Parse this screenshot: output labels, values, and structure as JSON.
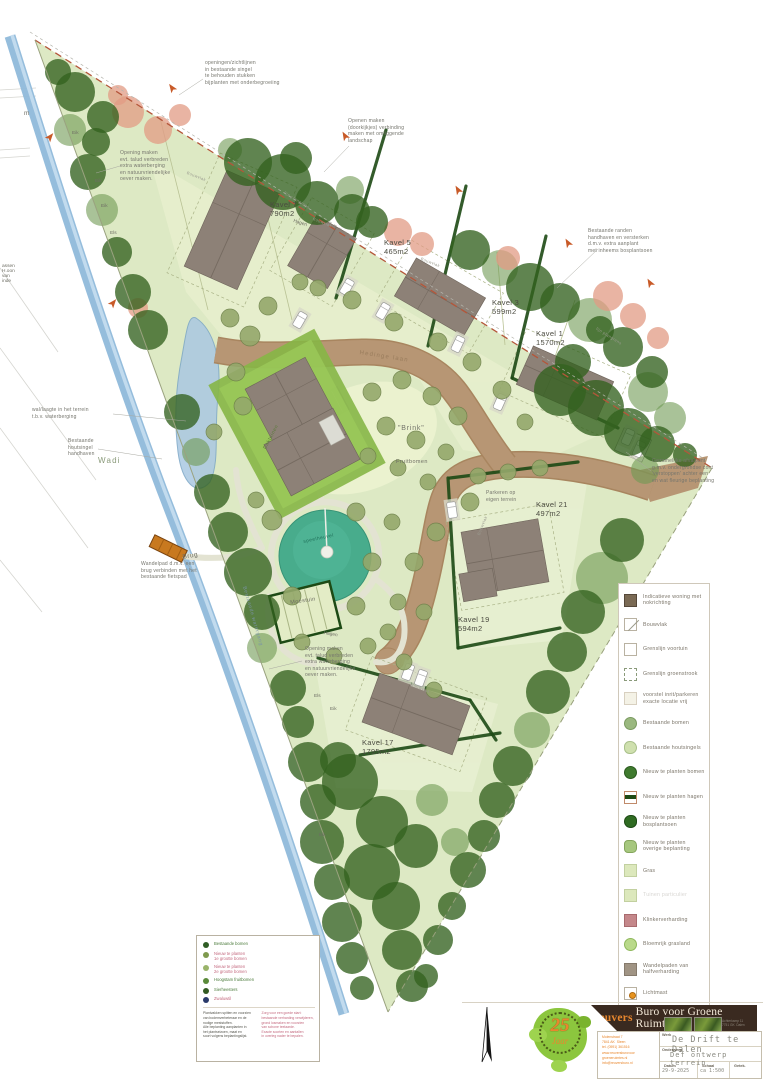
{
  "map": {
    "plots": [
      {
        "name": "Kavel 7",
        "area": "790m2"
      },
      {
        "name": "Kavel 5",
        "area": "465m2"
      },
      {
        "name": "Kavel 3",
        "area": "599m2"
      },
      {
        "name": "Kavel 1",
        "area": "1570m2"
      },
      {
        "name": "Kavel 21",
        "area": "497m2"
      },
      {
        "name": "Kavel 19",
        "area": "594m2"
      },
      {
        "name": "Kavel 17",
        "area": "1795m2"
      }
    ],
    "annotations": {
      "openings_top": [
        "openingen/zichtlijnen",
        "in bestaande singel",
        "te behouden stukken",
        "bijplanten met onderbegroeiing"
      ],
      "doorkijkjes": [
        "Openen maken",
        "(doorkijkjes) verbinding",
        "maken met omliggende",
        "landschap"
      ],
      "talud_left": [
        "Opening maken",
        "evt. talud verbreden",
        "extra waterberging",
        "en natuurvriendelijke",
        "oever maken."
      ],
      "randen": [
        "Bestaande randen",
        "handhaven en versterken",
        "d.m.v. extra aanplant",
        "met inheems bosplantsoen"
      ],
      "wal": [
        "wal/laagte in het terrein",
        "t.b.v. waterberging"
      ],
      "houtsingel": [
        "Bestaande",
        "houtsingel",
        "handhaven"
      ],
      "afvalpunt": [
        "Gezamelijke afvalpunt",
        "g.m.v. ondergrondse cont",
        "'verstoppen' achter een",
        "en wat fleurige beplanting"
      ],
      "wandelpad": [
        "Wandelpad d.m.v. een",
        "brug verbinden met het",
        "bestaande fietspad"
      ],
      "talud_south": [
        "Opening maken",
        "evt. talud verbreden",
        "extra waterberging",
        "en natuurvriendelijke",
        "oever maken."
      ],
      "parkeren": [
        "Parkeren op",
        "eigen terrein"
      ]
    },
    "labels": {
      "brink": "\"Brink\"",
      "fruitbomen": "Fruitbomen",
      "wadi": "Wadi",
      "brug": "Brug",
      "moestuin": "Moestuin",
      "hagen": "Hagen",
      "speelheuvel": "speelheuvel",
      "daktuinen": "Daktuinen",
      "watergang": "Bestaande watergang",
      "bouwvlak": "Bouwvlak",
      "grens": "lijn plangrens",
      "straat": "Hedinge laan",
      "eik": "Eik",
      "els": "Els",
      "m": "m",
      "cut_text": "assen\nH.oon\nvan\ninde"
    }
  },
  "legend_right": {
    "items": [
      {
        "label": "Indicatieve woning\nmet nokrichting",
        "type": "woning"
      },
      {
        "label": "Bouwvlak",
        "type": "diag"
      },
      {
        "label": "Grenslijn voortuin",
        "type": "voortuin"
      },
      {
        "label": "Grenslijn groenstrook",
        "type": "dashdot"
      },
      {
        "label": "voorstel inrit/parkeren\nexacte locatie vrij",
        "type": "inrit"
      },
      {
        "label": "Bestaande bomen",
        "type": "circ_best"
      },
      {
        "label": "Bestaande houtsingels",
        "type": "blob_pale"
      },
      {
        "label": "Nieuw te planten bomen",
        "type": "circ_new"
      },
      {
        "label": "Nieuw te planten hagen",
        "type": "bar"
      },
      {
        "label": "Nieuw te planten\nbosplantsoen",
        "type": "blob_dark"
      },
      {
        "label": "Nieuw te planten\noverige beplanting",
        "type": "blob_mid"
      },
      {
        "label": "Gras",
        "type": "gras"
      },
      {
        "label": "Tuinen particulier",
        "type": "tuin",
        "faint": true
      },
      {
        "label": "Klinkerverharding",
        "type": "klinker"
      },
      {
        "label": "Bloemrijk grasland",
        "type": "bloem"
      },
      {
        "label": "Wandelpaden van\nhalfverharding",
        "type": "half"
      },
      {
        "label": "Lichtmast",
        "type": "mast"
      }
    ]
  },
  "legend_box": {
    "items": [
      {
        "dot": "#2f5d25",
        "cls": "lb-green",
        "lines": [
          "Bestaande bomen"
        ]
      },
      {
        "dot": "#7f9a4e",
        "cls": "lb-pink",
        "lines": [
          "Nieuw te planten",
          "1e grootte bomen"
        ]
      },
      {
        "dot": "#9ab46a",
        "cls": "lb-pink",
        "lines": [
          "Nieuw te planten",
          "2e grootte bomen"
        ]
      },
      {
        "dot": "#5a8a3a",
        "cls": "lb-green",
        "lines": [
          "Hoogstam fruitbomen"
        ]
      },
      {
        "dot": "#335a22",
        "cls": "lb-green",
        "lines": [
          "Sierheesters"
        ]
      },
      {
        "dot": "#2a3a6a",
        "cls": "lb-pink",
        "lines": [
          "Zwaluwtil"
        ]
      }
    ],
    "note_black": "Plantvakken spitten en voorzien\nvan bodemverbeteraar en de\nnodige meststoffen.\nAlle beplanting aanplanten in\nhet plantseizoen, maat en\nsoort volgens beplantingslijst.",
    "note_pink": "Zorg voor een goede start:\nbestaande verharding verwijderen,\ngrond losmaken en voorzien\nvan schone teelaarde.\nExacte soorten en aantallen\nin overleg nader te bepalen."
  },
  "title_block": {
    "firm_prefix": "Reuvers",
    "firm_rest": "Buro voor Groene Ruimtes",
    "logo": {
      "big": "25",
      "script": "Jaar"
    },
    "address_lines": [
      "Molenstraat 7",
      "7841 AK  Sleen",
      "tel. (0591) 361516"
    ],
    "web_lines": [
      "www.reuversburovoor",
      "groeneruimtes.nl",
      "info@reuversburo.nl"
    ],
    "photo_caption_lines": [
      "Achterkamp 11",
      "7751 GK  Dalen"
    ],
    "fields": {
      "werk_label": "Werk",
      "werk": "De Drift te Dalen",
      "onderwerp_label": "Onderwerp",
      "onderwerp": "Def ontwerp terrein",
      "datum_label": "Datum",
      "datum": "29-9-2025",
      "schaal_label": "Schaal",
      "schaal": "ca 1:500",
      "getek_label": "Getek."
    }
  },
  "colors": {
    "grass": "#dde9c4",
    "grass_light": "#e8f0d2",
    "tree_dark": "#33621f",
    "tree_light": "#6f9a53",
    "tree_olive": "#94a86b",
    "shrub_salmon": "#e29b84",
    "road": "#b79674",
    "road_edge": "#a8855f",
    "path": "#e3e3d2",
    "water": "#8fb9da",
    "wadi": "#aac8e2",
    "building": "#8d8177",
    "hedge": "#1d4a15",
    "mound_teal": "#41a98a",
    "bridge": "#c8791f",
    "arrow_orange": "#c85a28",
    "banner": "#3a2a20",
    "brand_orange": "#e8872e",
    "logo_green": "#8cc63e",
    "pink": "#c4697f"
  }
}
